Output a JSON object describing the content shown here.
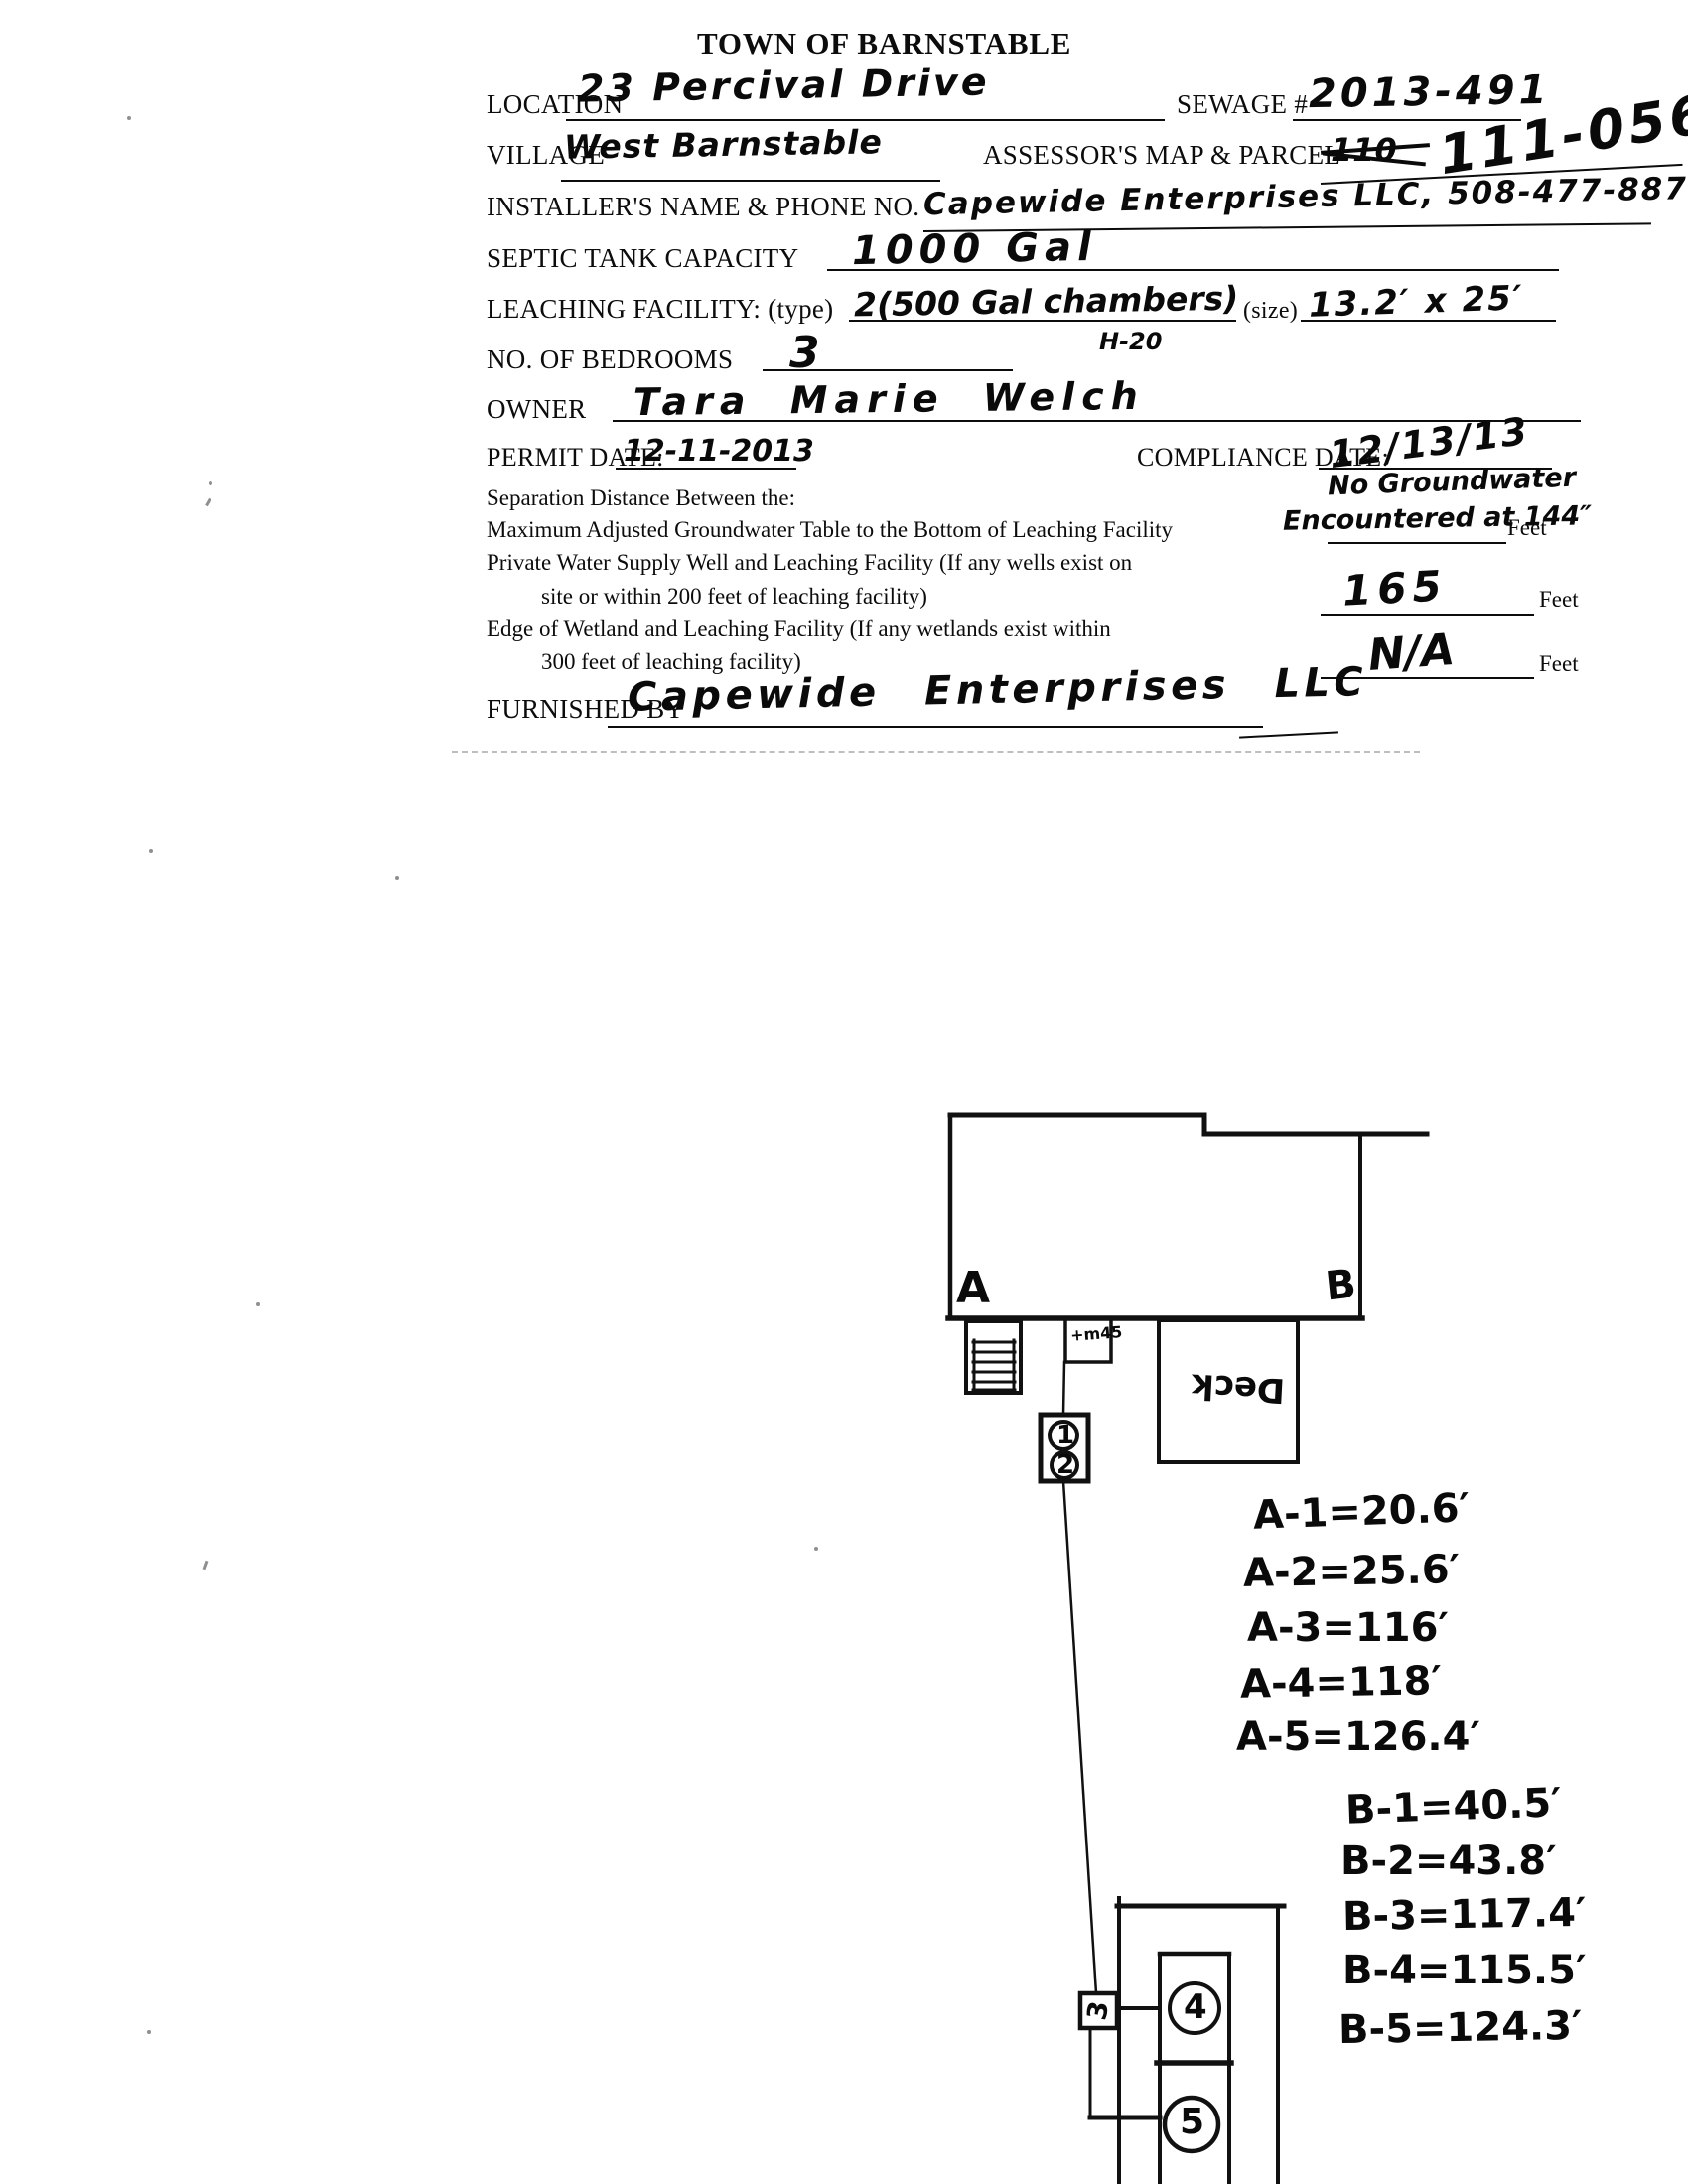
{
  "document": {
    "title": "TOWN OF BARNSTABLE"
  },
  "form": {
    "location": {
      "label": "LOCATION",
      "value": "23 Percival Drive"
    },
    "sewage": {
      "label": "SEWAGE #",
      "value": "2013-491"
    },
    "village": {
      "label": "VILLAGE",
      "value": "West Barnstable"
    },
    "assessors_map_parcel": {
      "label": "ASSESSOR'S MAP & PARCEL",
      "crossed_out": "110",
      "value": "111-056"
    },
    "installer": {
      "label": "INSTALLER'S NAME & PHONE NO.",
      "value": "Capewide Enterprises LLC, 508-477-8877"
    },
    "septic_tank_capacity": {
      "label": "SEPTIC TANK CAPACITY",
      "value": "1000 Gal"
    },
    "leaching_facility": {
      "label": "LEACHING FACILITY: (type)",
      "type_value": "2(500 Gal chambers)",
      "rating_note": "H-20",
      "size_label": "(size)",
      "size_value": "13.2′ x 25′"
    },
    "bedrooms": {
      "label": "NO. OF BEDROOMS",
      "value": "3"
    },
    "owner": {
      "label": "OWNER",
      "value": "Tara Marie Welch"
    },
    "permit_date": {
      "label": "PERMIT DATE:",
      "value": "12-11-2013"
    },
    "compliance_date": {
      "label": "COMPLIANCE DATE:",
      "value": "12/13/13"
    },
    "separation_heading": "Separation Distance Between the:",
    "groundwater": {
      "label": "Maximum Adjusted Groundwater Table to the Bottom of Leaching Facility",
      "handwritten_line1": "No Groundwater",
      "handwritten_line2": "Encountered at 144″",
      "unit": "Feet"
    },
    "well": {
      "label_line1": "Private Water Supply Well and Leaching Facility (If any wells exist on",
      "label_line2": "site or within 200 feet of leaching facility)",
      "value": "165",
      "unit": "Feet"
    },
    "wetland": {
      "label_line1": "Edge of Wetland and Leaching Facility (If any wetlands exist within",
      "label_line2": "300 feet of leaching facility)",
      "value": "N/A",
      "unit": "Feet"
    },
    "furnished_by": {
      "label": "FURNISHED BY",
      "value": "Capewide Enterprises LLC"
    }
  },
  "sketch": {
    "corner_a": "A",
    "corner_b": "B",
    "deck_label": "Deck",
    "meter_note": "+m45",
    "component_1": "1",
    "component_2": "2",
    "component_3": "3",
    "component_4": "4",
    "component_5": "5",
    "measurements_a": [
      "A-1=20.6′",
      "A-2=25.6′",
      "A-3=116′",
      "A-4=118′",
      "A-5=126.4′"
    ],
    "measurements_b": [
      "B-1=40.5′",
      "B-2=43.8′",
      "B-3=117.4′",
      "B-4=115.5′",
      "B-5=124.3′"
    ]
  }
}
